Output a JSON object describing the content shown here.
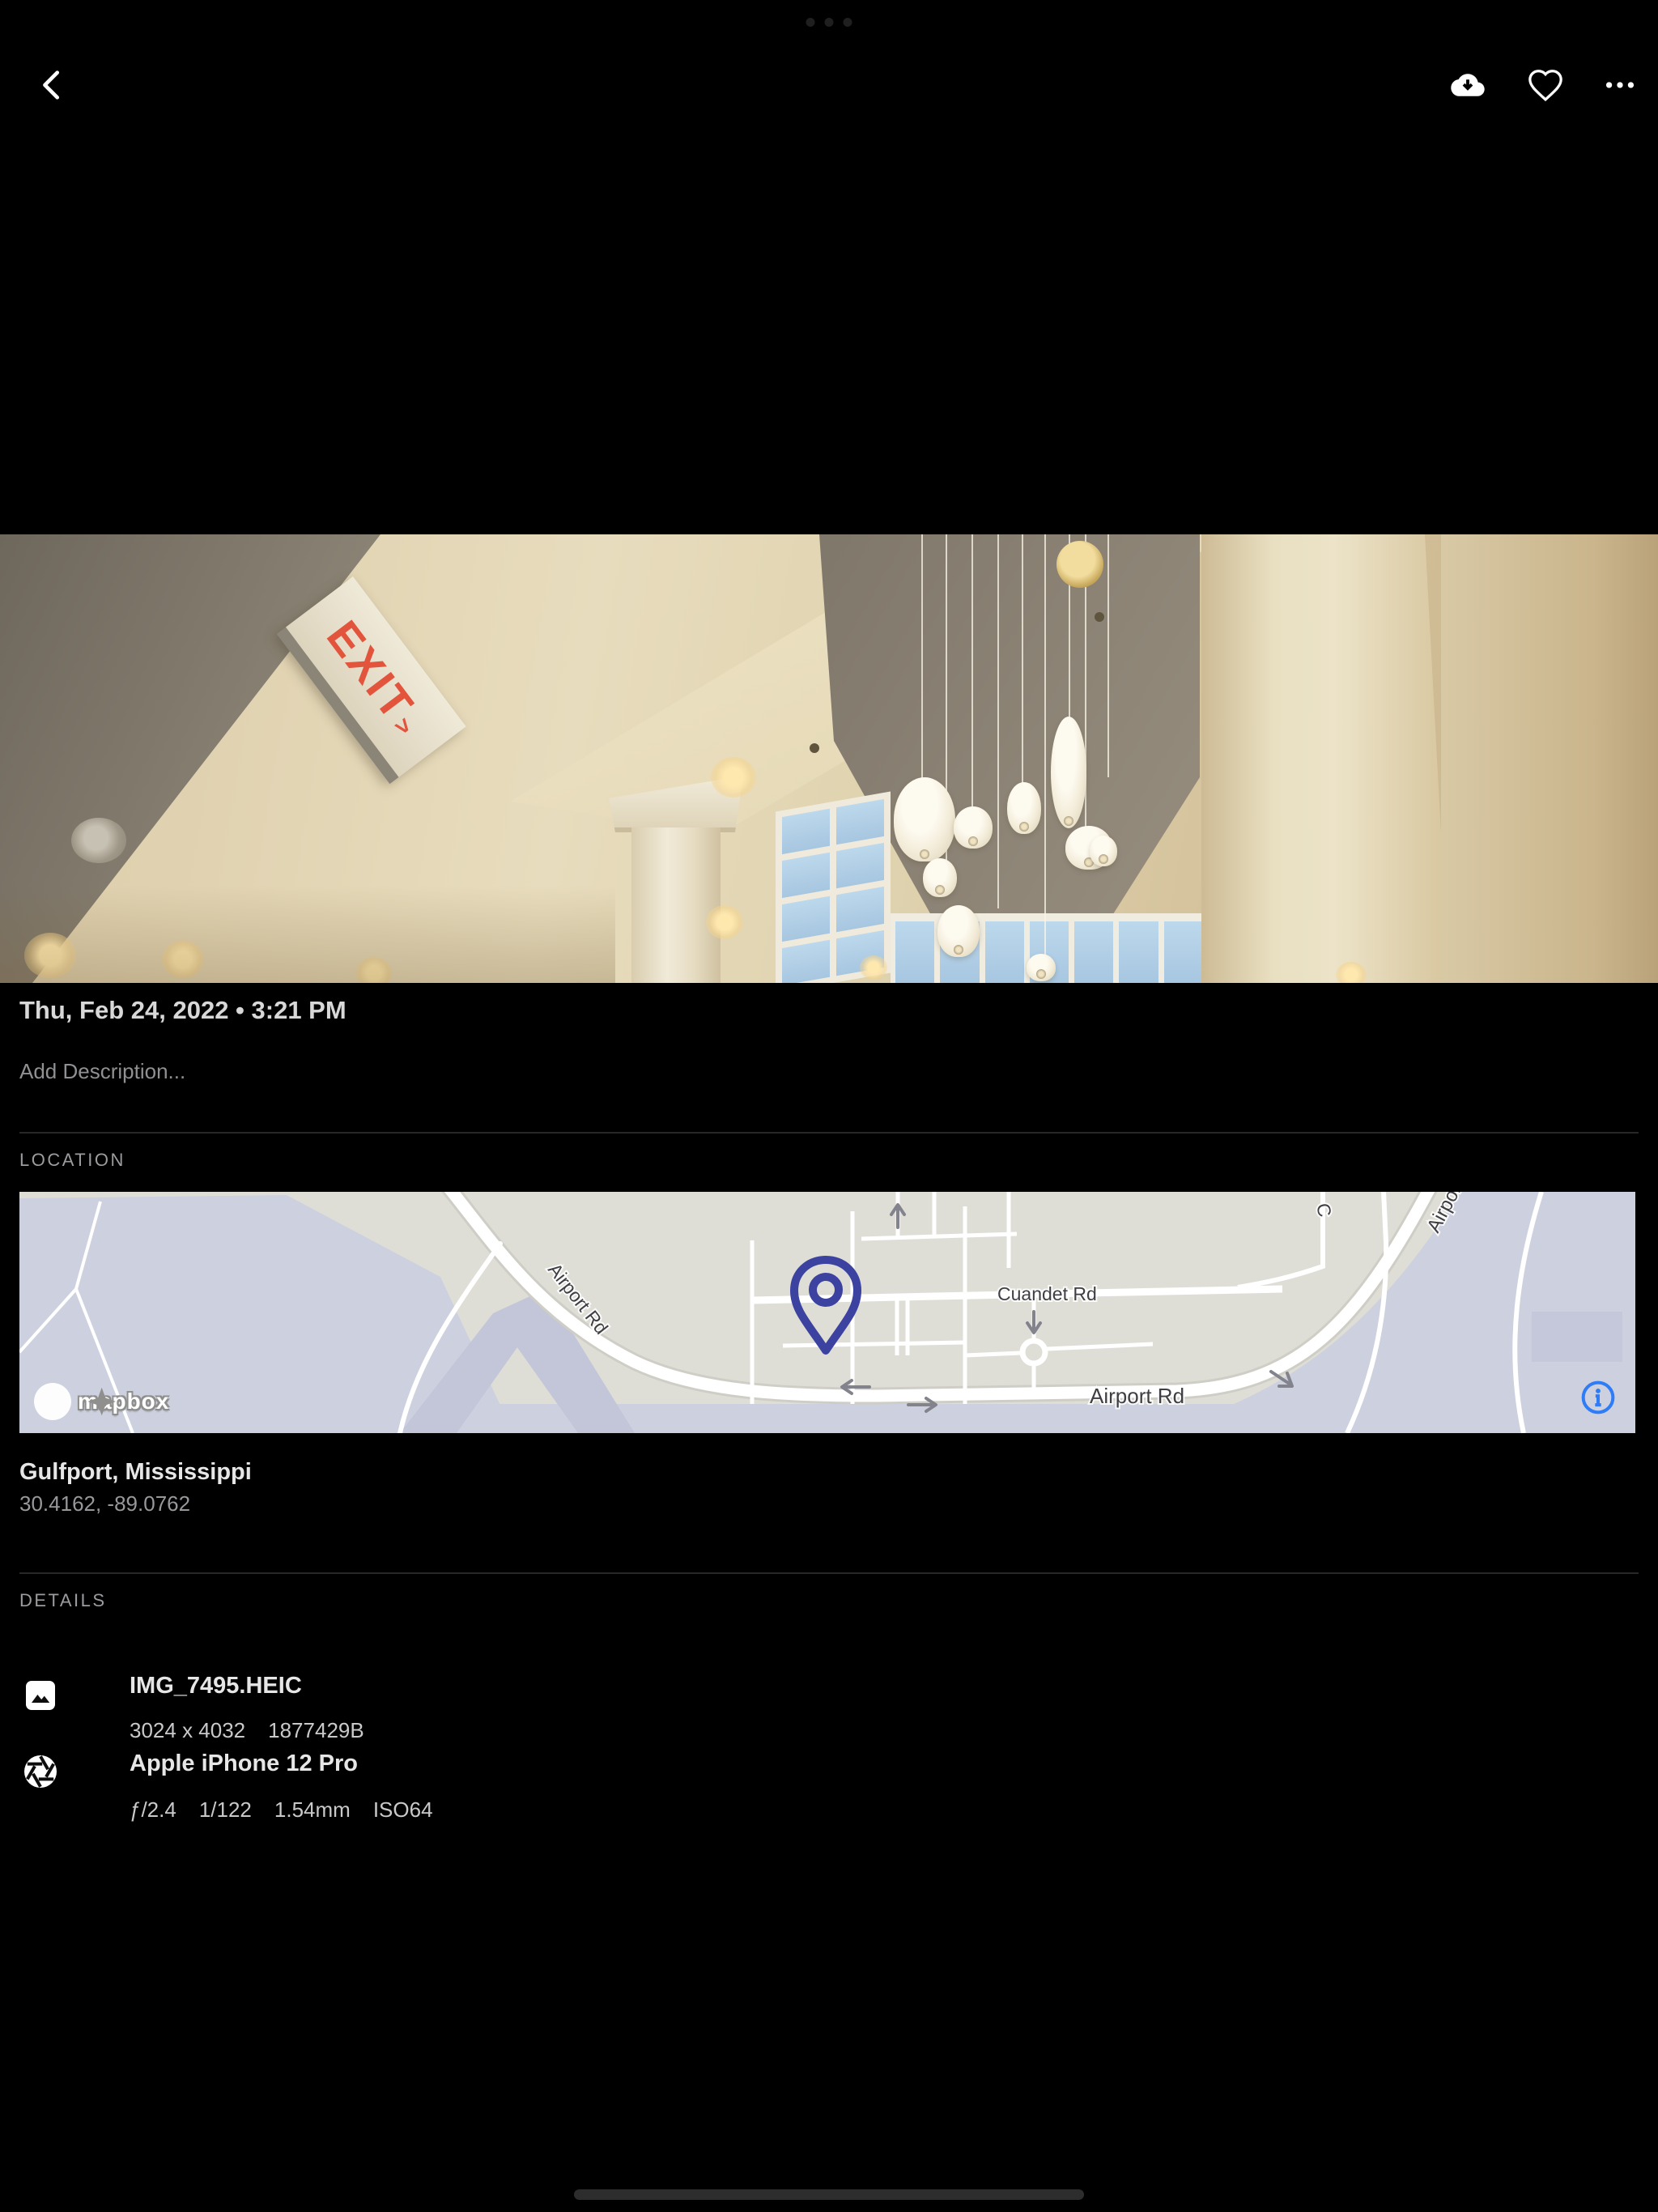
{
  "photo": {
    "exit_sign_text": "EXIT",
    "exit_sign_arrow": ">"
  },
  "timeline": {
    "date": "Thu, Feb 24, 2022 • 3:21 PM",
    "description_placeholder": "Add Description..."
  },
  "location": {
    "label": "LOCATION",
    "place": "Gulfport, Mississippi",
    "coordinates": "30.4162, -89.0762",
    "map": {
      "road_label_airport_west": "Airport Rd",
      "road_label_cuandet": "Cuandet Rd",
      "road_label_airport_main": "Airport Rd",
      "road_label_airport_northeast": "Airport Rd",
      "road_label_partial_north": "C",
      "attribution": "mapbox"
    }
  },
  "details": {
    "label": "DETAILS",
    "file": {
      "name": "IMG_7495.HEIC",
      "dimensions": "3024 x 4032",
      "size": "1877429B"
    },
    "camera": {
      "name": "Apple iPhone 12 Pro",
      "aperture": "ƒ/2.4",
      "shutter_speed": "1/122",
      "focal_length": "1.54mm",
      "iso": "ISO64"
    }
  },
  "colors": {
    "map_pin": "#3b429f",
    "info_icon": "#2e7cf6",
    "exit_sign_red": "#e2543c",
    "map_land": "#dfded6",
    "map_field": "#ccd0df"
  }
}
